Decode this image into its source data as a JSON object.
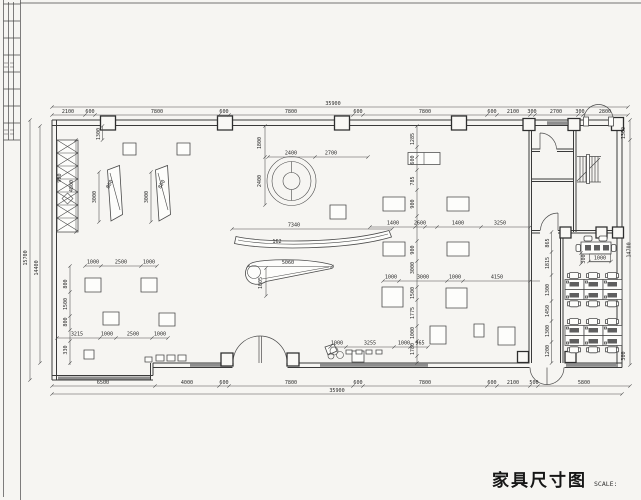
{
  "title_block": {
    "title": "家具尺寸图",
    "scale": "SCALE: 1:110"
  },
  "plan": {
    "stroke": "#3a3a3a",
    "dim_labels": [
      {
        "t": "35900",
        "x": 333,
        "y": 105
      },
      {
        "t": "2100",
        "x": 68,
        "y": 113
      },
      {
        "t": "600",
        "x": 90,
        "y": 113
      },
      {
        "t": "7800",
        "x": 157,
        "y": 113
      },
      {
        "t": "600",
        "x": 224,
        "y": 113
      },
      {
        "t": "7800",
        "x": 291,
        "y": 113
      },
      {
        "t": "600",
        "x": 358,
        "y": 113
      },
      {
        "t": "7800",
        "x": 425,
        "y": 113
      },
      {
        "t": "600",
        "x": 492,
        "y": 113
      },
      {
        "t": "2100",
        "x": 513,
        "y": 113
      },
      {
        "t": "300",
        "x": 532,
        "y": 113
      },
      {
        "t": "2700",
        "x": 556,
        "y": 113
      },
      {
        "t": "300",
        "x": 580,
        "y": 113
      },
      {
        "t": "2800",
        "x": 605,
        "y": 113
      },
      {
        "t": "6500",
        "x": 103,
        "y": 384
      },
      {
        "t": "4000",
        "x": 187,
        "y": 384
      },
      {
        "t": "600",
        "x": 224,
        "y": 384
      },
      {
        "t": "7800",
        "x": 291,
        "y": 384
      },
      {
        "t": "600",
        "x": 358,
        "y": 384
      },
      {
        "t": "7800",
        "x": 425,
        "y": 384
      },
      {
        "t": "600",
        "x": 492,
        "y": 384
      },
      {
        "t": "2100",
        "x": 513,
        "y": 384
      },
      {
        "t": "500",
        "x": 534,
        "y": 384
      },
      {
        "t": "5800",
        "x": 584,
        "y": 384
      },
      {
        "t": "35900",
        "x": 337,
        "y": 392
      },
      {
        "t": "15700",
        "x": 27,
        "y": 258,
        "r": -90
      },
      {
        "t": "14400",
        "x": 38,
        "y": 268,
        "r": -90
      },
      {
        "t": "1300",
        "x": 100,
        "y": 134,
        "r": -90
      },
      {
        "t": "4800",
        "x": 73,
        "y": 186,
        "r": -90
      },
      {
        "t": "900",
        "x": 61,
        "y": 178,
        "r": -90
      },
      {
        "t": "800",
        "x": 67,
        "y": 284,
        "r": -90
      },
      {
        "t": "1500",
        "x": 67,
        "y": 304,
        "r": -90
      },
      {
        "t": "800",
        "x": 67,
        "y": 322,
        "r": -90
      },
      {
        "t": "330",
        "x": 67,
        "y": 350,
        "r": -90
      },
      {
        "t": "1000",
        "x": 93,
        "y": 263.5
      },
      {
        "t": "2500",
        "x": 121,
        "y": 263.5
      },
      {
        "t": "1000",
        "x": 149,
        "y": 263.5
      },
      {
        "t": "3215",
        "x": 77,
        "y": 335.5
      },
      {
        "t": "1000",
        "x": 107,
        "y": 335.5
      },
      {
        "t": "2500",
        "x": 133,
        "y": 335.5
      },
      {
        "t": "1000",
        "x": 160,
        "y": 335.5
      },
      {
        "t": "3000",
        "x": 96,
        "y": 197,
        "r": -90
      },
      {
        "t": "800",
        "x": 111,
        "y": 185,
        "r": -60
      },
      {
        "t": "3000",
        "x": 148,
        "y": 197,
        "r": -90
      },
      {
        "t": "800",
        "x": 163,
        "y": 185,
        "r": -60
      },
      {
        "t": "1800",
        "x": 261,
        "y": 143,
        "r": -90
      },
      {
        "t": "2400",
        "x": 261,
        "y": 181,
        "r": -90
      },
      {
        "t": "2400",
        "x": 291,
        "y": 154.5
      },
      {
        "t": "2700",
        "x": 331,
        "y": 154.5
      },
      {
        "t": "7340",
        "x": 294,
        "y": 226.5
      },
      {
        "t": "162",
        "x": 277,
        "y": 243
      },
      {
        "t": "5060",
        "x": 288,
        "y": 264
      },
      {
        "t": "1005",
        "x": 262,
        "y": 283,
        "r": -90
      },
      {
        "t": "1285",
        "x": 414,
        "y": 139,
        "r": -90
      },
      {
        "t": "600",
        "x": 414,
        "y": 160,
        "r": -90
      },
      {
        "t": "785",
        "x": 414,
        "y": 181,
        "r": -90
      },
      {
        "t": "900",
        "x": 414,
        "y": 204,
        "r": -90
      },
      {
        "t": "900",
        "x": 414,
        "y": 250,
        "r": -90
      },
      {
        "t": "3000",
        "x": 414,
        "y": 268,
        "r": -90
      },
      {
        "t": "1500",
        "x": 414,
        "y": 293,
        "r": -90
      },
      {
        "t": "1775",
        "x": 414,
        "y": 313,
        "r": -90
      },
      {
        "t": "1000",
        "x": 414,
        "y": 333,
        "r": -90
      },
      {
        "t": "1780",
        "x": 414,
        "y": 349,
        "r": -90
      },
      {
        "t": "1400",
        "x": 393,
        "y": 224.5
      },
      {
        "t": "2600",
        "x": 420,
        "y": 224.5
      },
      {
        "t": "1400",
        "x": 458,
        "y": 224.5
      },
      {
        "t": "3250",
        "x": 500,
        "y": 224.5
      },
      {
        "t": "1000",
        "x": 391,
        "y": 278.5
      },
      {
        "t": "3000",
        "x": 423,
        "y": 278.5
      },
      {
        "t": "1000",
        "x": 455,
        "y": 278.5
      },
      {
        "t": "4150",
        "x": 497,
        "y": 278.5
      },
      {
        "t": "1000",
        "x": 337,
        "y": 344.5
      },
      {
        "t": "3255",
        "x": 370,
        "y": 344.5
      },
      {
        "t": "1000",
        "x": 404,
        "y": 344.5
      },
      {
        "t": "965",
        "x": 420,
        "y": 344.5
      },
      {
        "t": "865",
        "x": 549,
        "y": 243,
        "r": -90
      },
      {
        "t": "1815",
        "x": 549,
        "y": 263,
        "r": -90
      },
      {
        "t": "1300",
        "x": 549,
        "y": 290,
        "r": -90
      },
      {
        "t": "1450",
        "x": 549,
        "y": 311,
        "r": -90
      },
      {
        "t": "1300",
        "x": 549,
        "y": 331,
        "r": -90
      },
      {
        "t": "1200",
        "x": 549,
        "y": 351,
        "r": -90
      },
      {
        "t": "300",
        "x": 585,
        "y": 259,
        "r": -90
      },
      {
        "t": "1000",
        "x": 600,
        "y": 259.3
      },
      {
        "t": "1300",
        "x": 625,
        "y": 133,
        "r": -90
      },
      {
        "t": "14700",
        "x": 630.5,
        "y": 250,
        "r": -90
      },
      {
        "t": "300",
        "x": 625,
        "y": 356,
        "r": -90
      }
    ],
    "dim_lines": [
      {
        "o": "h",
        "c": 107,
        "a": 52,
        "b": 628,
        "t": [
          52,
          628
        ]
      },
      {
        "o": "h",
        "c": 115,
        "a": 52,
        "b": 628,
        "t": [
          52,
          85,
          95,
          219,
          229,
          353,
          363,
          487,
          497,
          530,
          535,
          578,
          583,
          628
        ]
      },
      {
        "o": "h",
        "c": 386,
        "a": 52,
        "b": 630,
        "t": [
          52,
          155,
          219,
          229,
          353,
          363,
          487,
          497,
          530,
          538,
          630
        ]
      },
      {
        "o": "h",
        "c": 394,
        "a": 52,
        "b": 622,
        "t": [
          52,
          622
        ]
      },
      {
        "o": "v",
        "c": 30,
        "a": 120,
        "b": 380,
        "t": [
          120,
          380
        ]
      },
      {
        "o": "v",
        "c": 40,
        "a": 126,
        "b": 363,
        "t": [
          126,
          363
        ]
      },
      {
        "o": "v",
        "c": 630,
        "a": 120,
        "b": 365,
        "t": [
          120,
          140,
          365
        ]
      },
      {
        "o": "v",
        "c": 102.5,
        "a": 126,
        "b": 140,
        "t": [
          126,
          140
        ]
      },
      {
        "o": "v",
        "c": 76,
        "a": 140,
        "b": 232,
        "t": [
          140,
          232
        ]
      },
      {
        "o": "v",
        "c": 70,
        "a": 266,
        "b": 365,
        "t": [
          266,
          292,
          316,
          330,
          341,
          363
        ]
      },
      {
        "o": "h",
        "c": 266,
        "a": 85,
        "b": 157,
        "t": [
          85,
          101,
          141,
          157
        ]
      },
      {
        "o": "h",
        "c": 338,
        "a": 57,
        "b": 168,
        "t": [
          57,
          100,
          116,
          152,
          168
        ]
      },
      {
        "o": "v",
        "c": 99,
        "a": 172,
        "b": 222,
        "t": [
          172,
          222
        ]
      },
      {
        "o": "v",
        "c": 151,
        "a": 172,
        "b": 222,
        "t": [
          172,
          222
        ]
      },
      {
        "o": "h",
        "c": 157,
        "a": 268,
        "b": 368,
        "t": [
          268,
          315,
          368
        ]
      },
      {
        "o": "v",
        "c": 265,
        "a": 126,
        "b": 205,
        "t": [
          126,
          157,
          205
        ]
      },
      {
        "o": "h",
        "c": 229,
        "a": 232,
        "b": 392,
        "t": [
          232,
          392
        ]
      },
      {
        "o": "h",
        "c": 266.5,
        "a": 248,
        "b": 332,
        "t": [
          248,
          332
        ]
      },
      {
        "o": "v",
        "c": 266,
        "a": 268,
        "b": 296,
        "t": [
          268,
          296
        ]
      },
      {
        "o": "v",
        "c": 417,
        "a": 126,
        "b": 363,
        "t": [
          126,
          147,
          157,
          170,
          190,
          216,
          241,
          261,
          287,
          300,
          326,
          341,
          356,
          363
        ]
      },
      {
        "o": "h",
        "c": 227,
        "a": 370,
        "b": 530,
        "t": [
          370,
          415,
          425,
          437,
          481,
          530
        ]
      },
      {
        "o": "h",
        "c": 281,
        "a": 383,
        "b": 540,
        "t": [
          383,
          399,
          447,
          463,
          530
        ]
      },
      {
        "o": "h",
        "c": 347,
        "a": 330,
        "b": 428,
        "t": [
          330,
          346,
          394,
          410,
          428
        ]
      },
      {
        "o": "v",
        "c": 551.5,
        "a": 232,
        "b": 363,
        "t": [
          232,
          252,
          275,
          301,
          321,
          342,
          363
        ]
      },
      {
        "o": "v",
        "c": 581,
        "a": 253,
        "b": 264,
        "t": [
          253,
          264
        ]
      },
      {
        "o": "h",
        "c": 261.5,
        "a": 589,
        "b": 611,
        "t": [
          589,
          611
        ]
      }
    ]
  }
}
